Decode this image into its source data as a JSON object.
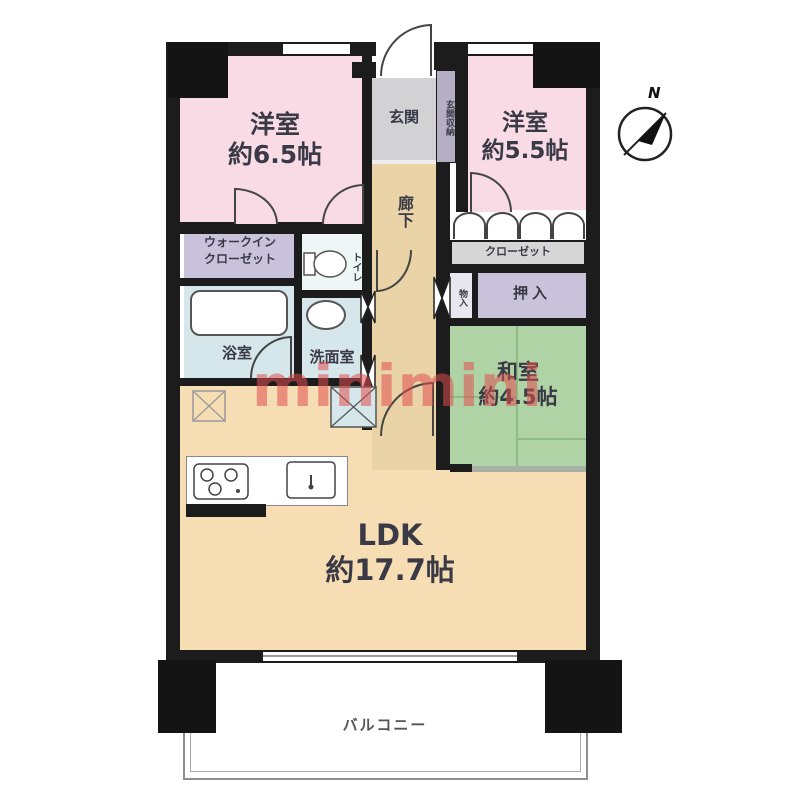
{
  "compass": {
    "label": "N"
  },
  "watermark": {
    "text": "minimini",
    "color": "#e04e4e"
  },
  "rooms": {
    "western1": {
      "name": "洋室",
      "area": "約6.5帖"
    },
    "western2": {
      "name": "洋室",
      "area": "約5.5帖"
    },
    "japanese": {
      "name": "和室",
      "area": "約4.5帖"
    },
    "ldk": {
      "name": "LDK",
      "area": "約17.7帖"
    },
    "entrance": {
      "name": "玄関"
    },
    "entrance_storage": {
      "name": "玄関収納"
    },
    "hallway": {
      "name": "廊下"
    },
    "walk_in_closet": {
      "line1": "ウォークイン",
      "line2": "クローゼット"
    },
    "toilet": {
      "name": "トイレ"
    },
    "bathroom": {
      "name": "浴室"
    },
    "washroom": {
      "name": "洗面室"
    },
    "closet": {
      "name": "クローゼット"
    },
    "oshiire": {
      "name": "押入"
    },
    "monoire": {
      "name": "物入"
    },
    "balcony": {
      "name": "バルコニー"
    }
  },
  "colors": {
    "wall": "#1c1c1c",
    "western_pink": "#f8dbe4",
    "japanese_green": "#b0d3a6",
    "ldk_beige": "#f6ddb4",
    "hallway_beige": "#e9d3a7",
    "closet_lavender": "#c8c3da",
    "wet_blue": "#d5e7ea",
    "closet_gray": "#d6d6d6",
    "entrance_gray": "#d2d2d4",
    "entrance_storage_lavender": "#b4afc5",
    "tatami_line": "#8fbc86"
  }
}
